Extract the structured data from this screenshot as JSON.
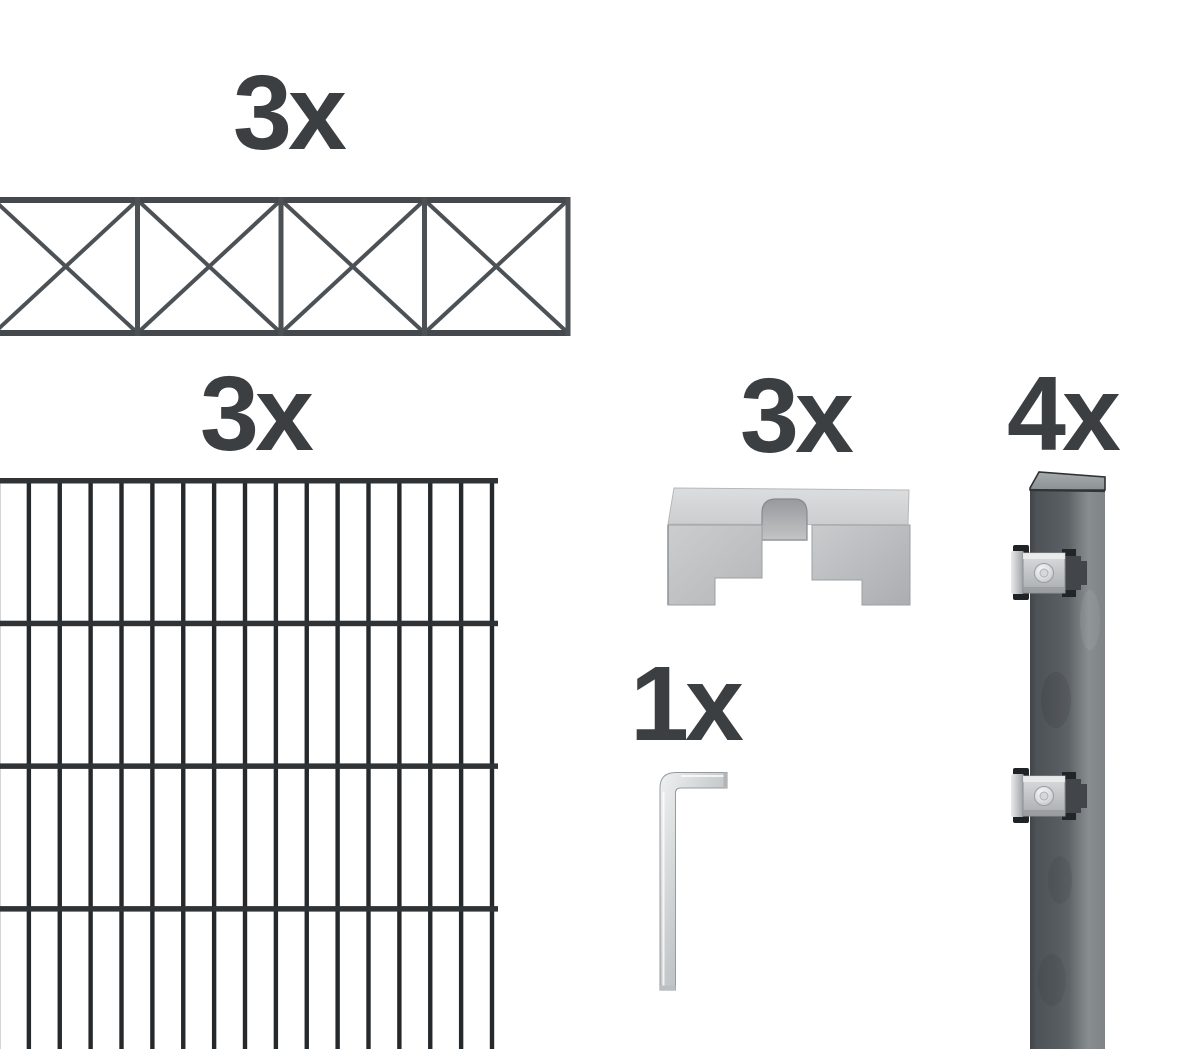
{
  "page": {
    "background_color": "#ffffff",
    "label_color": "#3b3f42",
    "description": "fence kit contents illustration"
  },
  "kit": {
    "ornament_panels": {
      "quantity": "3x",
      "icon": "ornamental-cross-brace-topper-panel",
      "sections": 4,
      "wire_color": "#4c5156",
      "rail_color": "#45494e"
    },
    "mesh_panels": {
      "quantity": "3x",
      "icon": "double-rod-mesh-fence-panel",
      "vertical_bars": 17,
      "horizontal_rails": 4,
      "bar_color": "#26292c",
      "rail_color": "#303336"
    },
    "cover_clamps": {
      "quantity": "3x",
      "icon": "galvanized-cover-clamp-bracket",
      "metal_color": "#c6c8ca"
    },
    "posts": {
      "quantity": "4x",
      "icon": "anthracite-square-post-with-clamps",
      "clamps": 2,
      "post_color": "#565b5f",
      "clamp_color": "#c9ccce"
    },
    "hex_key": {
      "quantity": "1x",
      "icon": "allen-hex-key",
      "metal_color": "#c6c9cb"
    }
  }
}
